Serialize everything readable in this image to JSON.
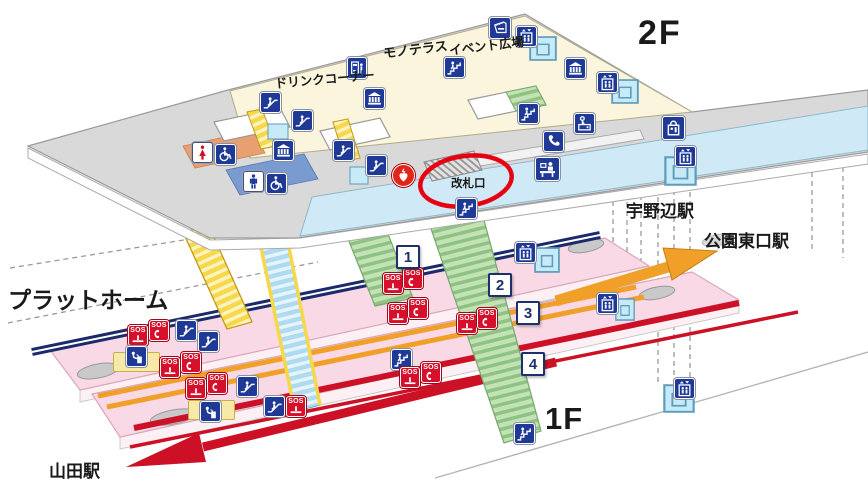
{
  "labels": {
    "floor_2f": "2F",
    "floor_1f": "1F",
    "platform": "プラットホーム",
    "mono_terrace": "モノテラス",
    "event_plaza": "イベント広場",
    "drink_corner": "ドリンクコーナー",
    "ticket_gate": "改札口",
    "station_unobe": "宇野辺駅",
    "station_koen_higashiguchi": "公園東口駅",
    "station_yamada": "山田駅",
    "sos": "SOS"
  },
  "platform_numbers": [
    "1",
    "2",
    "3",
    "4"
  ],
  "colors": {
    "concourse_floor": "#faf5dc",
    "walkway_floor": "#d9d9d9",
    "corridor_floor": "#cfe9f6",
    "platform_floor": "#f9d9e5",
    "escalator_yellow": "#f6d84a",
    "stairs_green": "#b9dcac",
    "line_navy": "#1a2a6c",
    "line_orange": "#f0a028",
    "line_red": "#cc1126",
    "icon_blue": "#1e3a96",
    "sos_red": "#d6102a",
    "highlight_red": "#e60012",
    "elevator_cyan": "#c6eaf8",
    "toilet_women_area": "#e8a070",
    "toilet_men_area": "#7a9bd0"
  },
  "icons": [
    {
      "type": "escalator",
      "x": 260,
      "y": 92
    },
    {
      "type": "escalator",
      "x": 292,
      "y": 110
    },
    {
      "type": "escalator",
      "x": 333,
      "y": 140
    },
    {
      "type": "escalator",
      "x": 366,
      "y": 155
    },
    {
      "type": "museum",
      "x": 273,
      "y": 140
    },
    {
      "type": "museum",
      "x": 364,
      "y": 88
    },
    {
      "type": "museum",
      "x": 565,
      "y": 58
    },
    {
      "type": "vending-machine",
      "x": 347,
      "y": 57,
      "w": 20,
      "h": 22
    },
    {
      "type": "stairs",
      "x": 444,
      "y": 57
    },
    {
      "type": "ticket-machine",
      "x": 489,
      "y": 17,
      "w": 22,
      "h": 22
    },
    {
      "type": "elevator-box",
      "x": 529,
      "y": 36,
      "w": 28,
      "h": 25
    },
    {
      "type": "elevator",
      "x": 516,
      "y": 26
    },
    {
      "type": "elevator-box",
      "x": 611,
      "y": 79,
      "w": 28,
      "h": 25
    },
    {
      "type": "elevator",
      "x": 597,
      "y": 72
    },
    {
      "type": "stairs",
      "x": 518,
      "y": 103
    },
    {
      "type": "phone",
      "x": 543,
      "y": 131
    },
    {
      "type": "coin-locker",
      "x": 574,
      "y": 113
    },
    {
      "type": "info-counter",
      "x": 535,
      "y": 157,
      "w": 25,
      "h": 24
    },
    {
      "type": "shop",
      "x": 662,
      "y": 116,
      "w": 23,
      "h": 24
    },
    {
      "type": "elevator-box",
      "x": 664,
      "y": 156,
      "w": 33,
      "h": 30
    },
    {
      "type": "elevator",
      "x": 675,
      "y": 146
    },
    {
      "type": "toilet-female",
      "x": 192,
      "y": 142
    },
    {
      "type": "wheelchair",
      "x": 215,
      "y": 144
    },
    {
      "type": "toilet-male",
      "x": 243,
      "y": 171
    },
    {
      "type": "wheelchair",
      "x": 266,
      "y": 173
    },
    {
      "type": "aed",
      "x": 392,
      "y": 164,
      "w": 23,
      "h": 23
    },
    {
      "type": "stairs",
      "x": 456,
      "y": 198
    },
    {
      "type": "sos-press",
      "x": 128,
      "y": 325,
      "w": 20,
      "h": 21
    },
    {
      "type": "sos-phone",
      "x": 149,
      "y": 320,
      "w": 20,
      "h": 21
    },
    {
      "type": "escalator",
      "x": 176,
      "y": 320
    },
    {
      "type": "escalator",
      "x": 198,
      "y": 331
    },
    {
      "type": "fountain-box",
      "x": 113,
      "y": 352,
      "w": 47,
      "h": 20
    },
    {
      "type": "fountain",
      "x": 126,
      "y": 346
    },
    {
      "type": "sos-press",
      "x": 160,
      "y": 357,
      "w": 20,
      "h": 21
    },
    {
      "type": "sos-phone",
      "x": 181,
      "y": 352,
      "w": 20,
      "h": 21
    },
    {
      "type": "sos-press",
      "x": 186,
      "y": 378,
      "w": 20,
      "h": 21
    },
    {
      "type": "sos-phone",
      "x": 207,
      "y": 373,
      "w": 20,
      "h": 21
    },
    {
      "type": "escalator",
      "x": 237,
      "y": 376
    },
    {
      "type": "escalator",
      "x": 264,
      "y": 396
    },
    {
      "type": "sos-press",
      "x": 286,
      "y": 396,
      "w": 20,
      "h": 21
    },
    {
      "type": "fountain-box",
      "x": 188,
      "y": 400,
      "w": 47,
      "h": 20
    },
    {
      "type": "fountain",
      "x": 200,
      "y": 401
    },
    {
      "type": "sos-press",
      "x": 383,
      "y": 273,
      "w": 20,
      "h": 21
    },
    {
      "type": "sos-phone",
      "x": 403,
      "y": 268,
      "w": 20,
      "h": 21
    },
    {
      "type": "sos-press",
      "x": 388,
      "y": 303,
      "w": 20,
      "h": 21
    },
    {
      "type": "sos-phone",
      "x": 408,
      "y": 298,
      "w": 20,
      "h": 21
    },
    {
      "type": "sos-press",
      "x": 457,
      "y": 313,
      "w": 20,
      "h": 21
    },
    {
      "type": "sos-phone",
      "x": 477,
      "y": 308,
      "w": 20,
      "h": 21
    },
    {
      "type": "stairs",
      "x": 391,
      "y": 349
    },
    {
      "type": "sos-press",
      "x": 400,
      "y": 367,
      "w": 20,
      "h": 21
    },
    {
      "type": "sos-phone",
      "x": 421,
      "y": 362,
      "w": 20,
      "h": 21
    },
    {
      "type": "elevator-box",
      "x": 534,
      "y": 247,
      "w": 26,
      "h": 26
    },
    {
      "type": "elevator",
      "x": 515,
      "y": 242
    },
    {
      "type": "elevator-box",
      "x": 615,
      "y": 298,
      "w": 20,
      "h": 23
    },
    {
      "type": "elevator",
      "x": 597,
      "y": 293
    },
    {
      "type": "elevator-box",
      "x": 663,
      "y": 384,
      "w": 32,
      "h": 29
    },
    {
      "type": "elevator",
      "x": 674,
      "y": 378
    },
    {
      "type": "stairs",
      "x": 514,
      "y": 423
    },
    {
      "type": "platform-number",
      "label": "1",
      "x": 396,
      "y": 245,
      "w": 24,
      "h": 24
    },
    {
      "type": "platform-number",
      "label": "2",
      "x": 488,
      "y": 273,
      "w": 24,
      "h": 24
    },
    {
      "type": "platform-number",
      "label": "3",
      "x": 516,
      "y": 301,
      "w": 24,
      "h": 24
    },
    {
      "type": "platform-number",
      "label": "4",
      "x": 521,
      "y": 352,
      "w": 24,
      "h": 24
    }
  ]
}
